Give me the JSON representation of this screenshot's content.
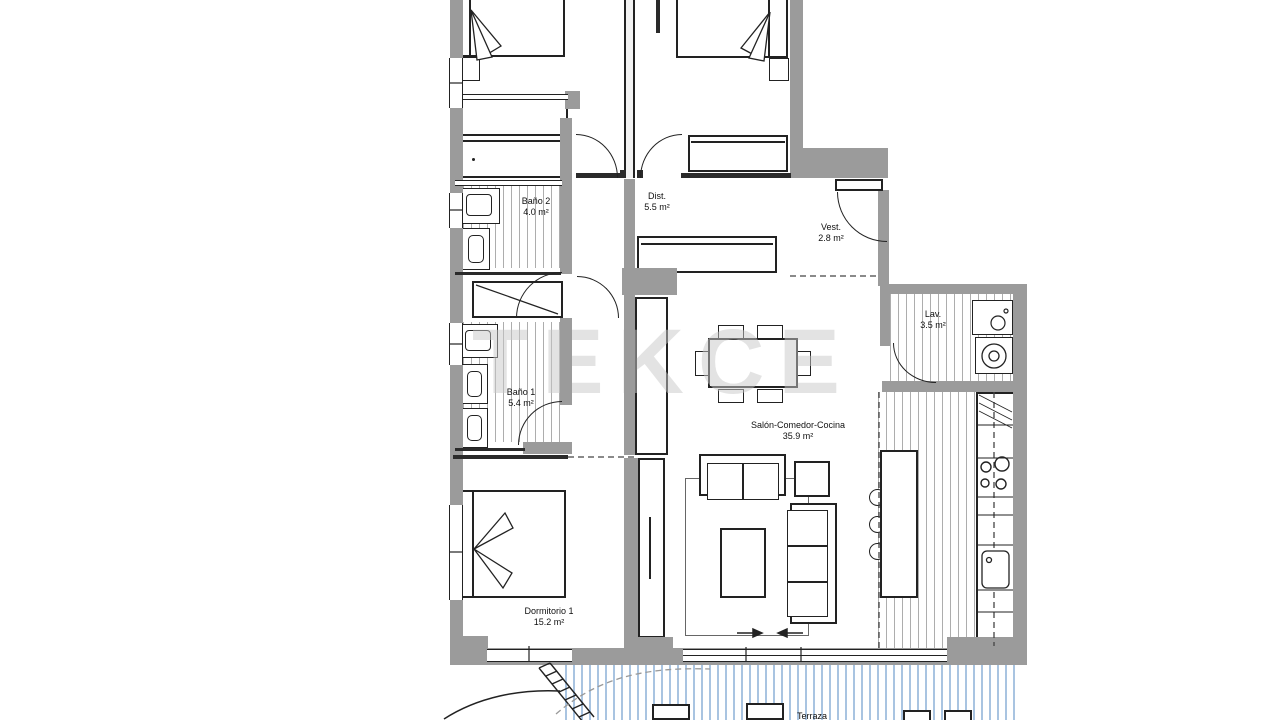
{
  "watermark": "TEKCE",
  "rooms": {
    "bano2": {
      "name": "Baño 2",
      "area": "4.0 m²"
    },
    "dist": {
      "name": "Dist.",
      "area": "5.5 m²"
    },
    "vest": {
      "name": "Vest.",
      "area": "2.8 m²"
    },
    "bano1": {
      "name": "Baño 1",
      "area": "5.4 m²"
    },
    "lav": {
      "name": "Lav.",
      "area": "3.5 m²"
    },
    "salon": {
      "name": "Salón-Comedor-Cocina",
      "area": "35.9 m²"
    },
    "dorm1": {
      "name": "Dormitorio 1",
      "area": "15.2 m²"
    },
    "terraza": {
      "name": "Terraza"
    }
  },
  "colors": {
    "wall": "#9b9b9b",
    "line": "#222222",
    "floor_hatch": "#adadad",
    "terrace_hatch": "#a9c4e1",
    "watermark": "#c9c9c9"
  }
}
